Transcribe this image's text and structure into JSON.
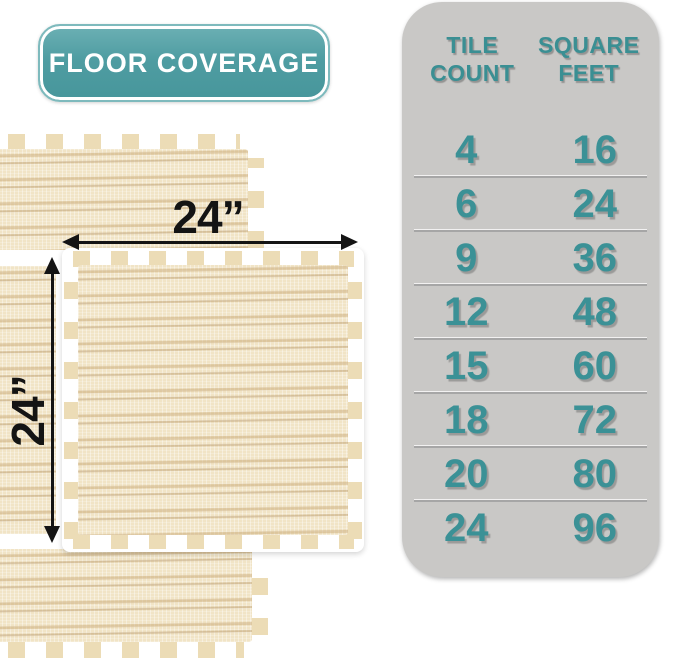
{
  "badge": {
    "label": "FLOOR COVERAGE",
    "bg_color": "#4f9da2",
    "text_color": "#ffffff"
  },
  "tile_diagram": {
    "width_label": "24”",
    "height_label": "24”",
    "tile_color": "#f1e4c6",
    "arrow_color": "#141414",
    "description": "interlocking foam tile with puzzle edges"
  },
  "coverage_table": {
    "columns": [
      "TILE COUNT",
      "SQUARE FEET"
    ],
    "rows": [
      {
        "tile_count": "4",
        "square_feet": "16"
      },
      {
        "tile_count": "6",
        "square_feet": "24"
      },
      {
        "tile_count": "9",
        "square_feet": "36"
      },
      {
        "tile_count": "12",
        "square_feet": "48"
      },
      {
        "tile_count": "15",
        "square_feet": "60"
      },
      {
        "tile_count": "18",
        "square_feet": "72"
      },
      {
        "tile_count": "20",
        "square_feet": "80"
      },
      {
        "tile_count": "24",
        "square_feet": "96"
      }
    ],
    "panel_bg": "#c9c8c6",
    "text_color": "#3b9196",
    "divider_color": "#a6a6a6"
  }
}
